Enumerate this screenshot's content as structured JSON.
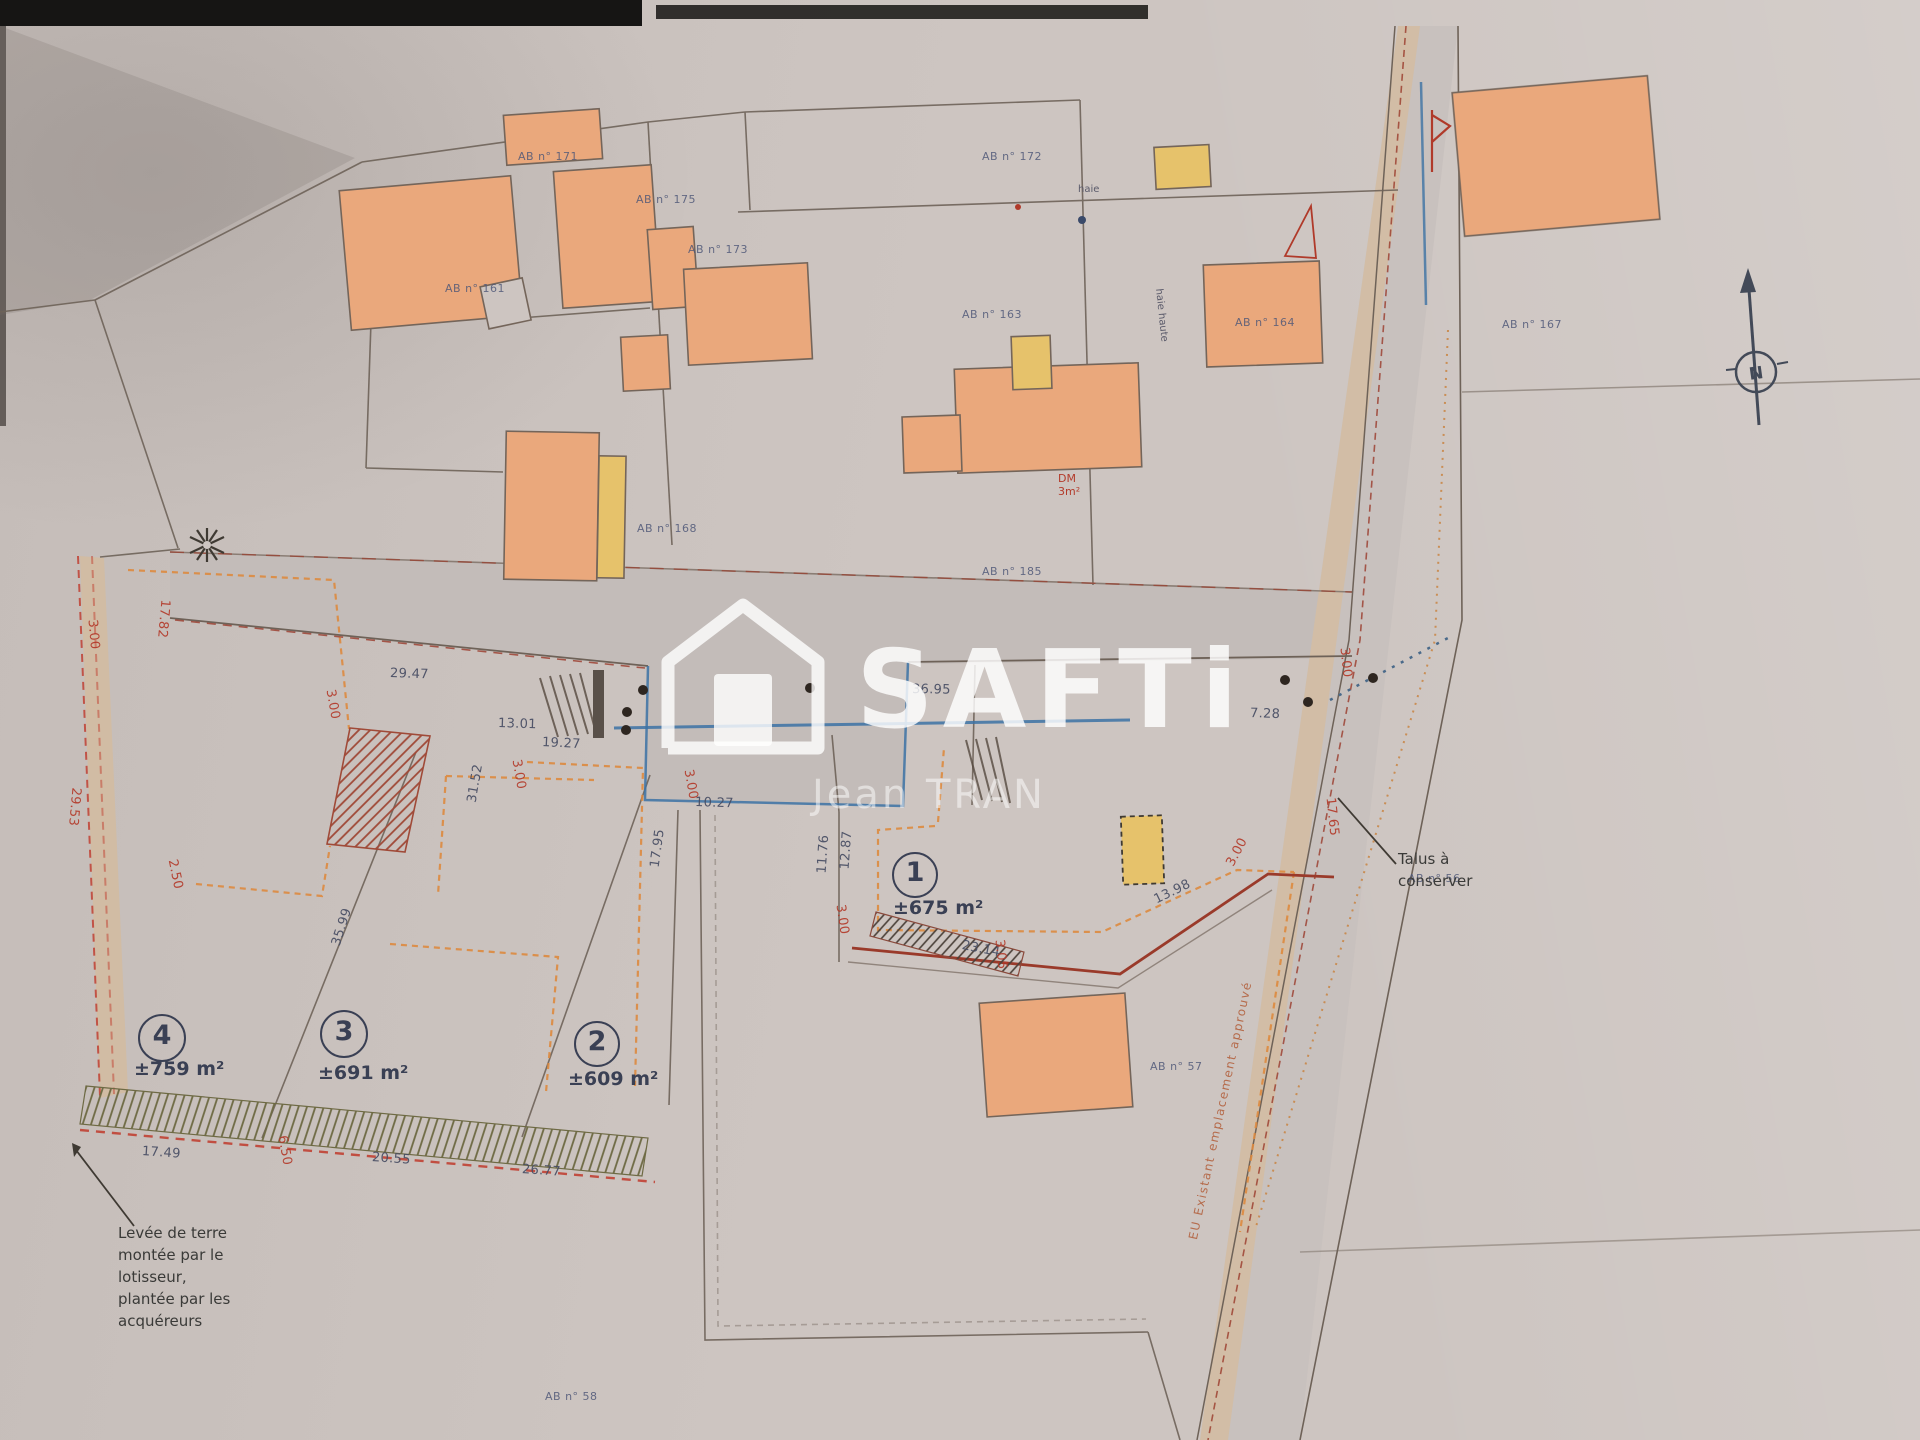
{
  "watermark": {
    "brand": "SAFTi",
    "agent": "Jean TRAN"
  },
  "north_label": "N",
  "notes": {
    "talus_line1": "Talus à",
    "talus_line2": "conserver",
    "levee": [
      "Levée de terre",
      "montée par le",
      "lotisseur,",
      "plantée par les",
      "acquéreurs"
    ],
    "haie": "haie",
    "haie_haute": "haie haute",
    "dm": "DM",
    "dm_area": "3m²",
    "road_side": "EU Existant emplacement approuvé"
  },
  "lots": [
    {
      "num": "1",
      "area": "±675 m²",
      "cx": 913,
      "cy": 873,
      "r": 21,
      "ax": 893,
      "ay": 897
    },
    {
      "num": "2",
      "area": "±609 m²",
      "cx": 595,
      "cy": 1042,
      "r": 21,
      "ax": 568,
      "ay": 1068
    },
    {
      "num": "3",
      "area": "±691 m²",
      "cx": 342,
      "cy": 1032,
      "r": 22,
      "ax": 318,
      "ay": 1062
    },
    {
      "num": "4",
      "area": "±759 m²",
      "cx": 160,
      "cy": 1036,
      "r": 22,
      "ax": 134,
      "ay": 1058
    }
  ],
  "parcels": [
    {
      "label": "AB n° 171",
      "x": 518,
      "y": 150
    },
    {
      "label": "AB n° 175",
      "x": 636,
      "y": 193
    },
    {
      "label": "AB n° 173",
      "x": 688,
      "y": 243
    },
    {
      "label": "AB n° 161",
      "x": 445,
      "y": 282
    },
    {
      "label": "AB n° 172",
      "x": 982,
      "y": 150
    },
    {
      "label": "AB n° 163",
      "x": 962,
      "y": 308
    },
    {
      "label": "AB n° 164",
      "x": 1235,
      "y": 316
    },
    {
      "label": "AB n° 167",
      "x": 1502,
      "y": 318
    },
    {
      "label": "AB n° 168",
      "x": 637,
      "y": 522
    },
    {
      "label": "AB n° 185",
      "x": 982,
      "y": 565
    },
    {
      "label": "AB n° 57",
      "x": 1150,
      "y": 1060
    },
    {
      "label": "AB n° 56",
      "x": 1408,
      "y": 872
    },
    {
      "label": "AB n° 58",
      "x": 545,
      "y": 1390
    }
  ],
  "dimensions": [
    {
      "t": "29.47",
      "x": 390,
      "y": 666,
      "rot": 2,
      "c": "d"
    },
    {
      "t": "13.01",
      "x": 498,
      "y": 716,
      "rot": 2,
      "c": "d"
    },
    {
      "t": "19.27",
      "x": 542,
      "y": 735,
      "rot": 3,
      "c": "d"
    },
    {
      "t": "10.27",
      "x": 695,
      "y": 795,
      "rot": 2,
      "c": "d"
    },
    {
      "t": "36.95",
      "x": 912,
      "y": 682,
      "rot": 1,
      "c": "d"
    },
    {
      "t": "3.00",
      "x": 330,
      "y": 682,
      "rot": 80,
      "c": "r"
    },
    {
      "t": "3.00",
      "x": 516,
      "y": 752,
      "rot": 80,
      "c": "r"
    },
    {
      "t": "3.00",
      "x": 688,
      "y": 762,
      "rot": 80,
      "c": "r"
    },
    {
      "t": "3.00",
      "x": 92,
      "y": 612,
      "rot": 85,
      "c": "r"
    },
    {
      "t": "17.82",
      "x": 165,
      "y": 592,
      "rot": 95,
      "c": "r"
    },
    {
      "t": "29.53",
      "x": 76,
      "y": 780,
      "rot": 95,
      "c": "r"
    },
    {
      "t": "2.50",
      "x": 172,
      "y": 852,
      "rot": 78,
      "c": "r"
    },
    {
      "t": "35.99",
      "x": 336,
      "y": 938,
      "rot": -72,
      "c": "d"
    },
    {
      "t": "31.52",
      "x": 472,
      "y": 795,
      "rot": -80,
      "c": "d"
    },
    {
      "t": "17.95",
      "x": 655,
      "y": 860,
      "rot": -82,
      "c": "d"
    },
    {
      "t": "11.76",
      "x": 822,
      "y": 866,
      "rot": -86,
      "c": "d"
    },
    {
      "t": "12.87",
      "x": 845,
      "y": 862,
      "rot": -86,
      "c": "d"
    },
    {
      "t": "3.00",
      "x": 840,
      "y": 897,
      "rot": 82,
      "c": "r"
    },
    {
      "t": "23.14",
      "x": 962,
      "y": 938,
      "rot": 11,
      "c": "d"
    },
    {
      "t": "3.05",
      "x": 999,
      "y": 932,
      "rot": 84,
      "c": "r"
    },
    {
      "t": "13.98",
      "x": 1155,
      "y": 893,
      "rot": -26,
      "c": "d"
    },
    {
      "t": "3.00",
      "x": 1230,
      "y": 858,
      "rot": -62,
      "c": "r"
    },
    {
      "t": "7.28",
      "x": 1250,
      "y": 706,
      "rot": 2,
      "c": "d"
    },
    {
      "t": "17.65",
      "x": 1330,
      "y": 790,
      "rot": 84,
      "c": "r"
    },
    {
      "t": "3.00",
      "x": 1344,
      "y": 640,
      "rot": 84,
      "c": "r"
    },
    {
      "t": "17.49",
      "x": 142,
      "y": 1144,
      "rot": 4,
      "c": "d"
    },
    {
      "t": "20.55",
      "x": 372,
      "y": 1150,
      "rot": 4,
      "c": "d"
    },
    {
      "t": "26.77",
      "x": 522,
      "y": 1162,
      "rot": 4,
      "c": "d"
    },
    {
      "t": "6.50",
      "x": 282,
      "y": 1128,
      "rot": 80,
      "c": "r"
    }
  ],
  "colors": {
    "paper": "#cdc5c1",
    "building_orange": "#eaa87c",
    "building_yellow": "#e6c26b",
    "line_dark": "#6e6258",
    "line_red": "#9a3a2a",
    "dash_orange": "#dd8a3f",
    "blue": "#3c72a4",
    "text_dark": "#474d63",
    "text_red": "#b33a2a"
  }
}
